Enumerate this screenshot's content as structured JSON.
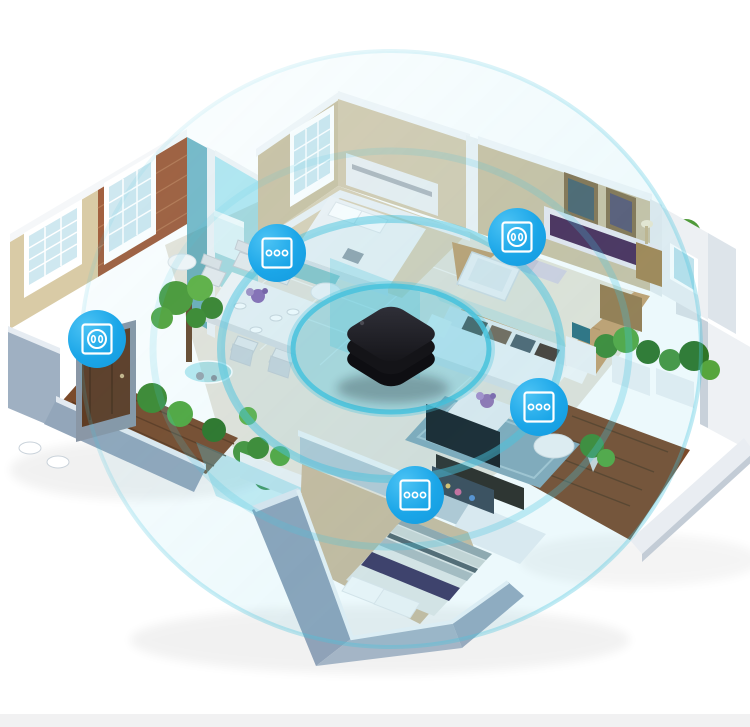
{
  "scene": {
    "type": "smart-home-product-render",
    "description": "Isometric 3D cutaway apartment; a black smart hub in the centre broadcasts teal wireless signal rings to blue smart wall-switch and power-outlet markers placed in each room",
    "background_color": "#ffffff",
    "footer_strip_color": "#f1f1f2"
  },
  "palette": {
    "device_blue": "#1ba6e8",
    "device_blue_light": "#4cc3f4",
    "wave_teal": "#49c3dd",
    "hub_black": "#1c1c20",
    "wall_tan": "#cfc4a6",
    "brick": "#a2603f",
    "wood_floor": "#c9a06c",
    "deck_wood": "#7b4a2a",
    "cut_wall_gray": "#93a6ba",
    "glass_teal": "#4ac4de"
  },
  "hub": {
    "label": "smart-hub",
    "cx": 391,
    "cy": 345
  },
  "waves": {
    "cx": 391,
    "cy": 349,
    "color": "#49c3dd",
    "rings": [
      {
        "rx": 104,
        "ry": 68,
        "fill_opacity": 0.32,
        "stroke_opacity": 0,
        "stroke_width": 0,
        "fade": false
      },
      {
        "rx": 98,
        "ry": 63,
        "fill_opacity": 0,
        "stroke_opacity": 0.85,
        "stroke_width": 5,
        "fade": false
      },
      {
        "rx": 170,
        "ry": 130,
        "fill_opacity": 0.06,
        "stroke_opacity": 0.5,
        "stroke_width": 8,
        "fade": false
      },
      {
        "rx": 238,
        "ry": 198,
        "fill_opacity": 0,
        "stroke_opacity": 0.3,
        "stroke_width": 7,
        "fade": true
      },
      {
        "rx": 310,
        "ry": 298,
        "fill_opacity": 0.1,
        "stroke_opacity": 0.35,
        "stroke_width": 4,
        "fade": true
      }
    ]
  },
  "devices": [
    {
      "id": "dining-switch",
      "type": "switch",
      "icon": "3-gang-switch-icon",
      "x": 277,
      "y": 253,
      "size": 58
    },
    {
      "id": "master-bedroom-outlet",
      "type": "outlet",
      "icon": "power-outlet-icon",
      "x": 517,
      "y": 237,
      "size": 58
    },
    {
      "id": "balcony-outlet",
      "type": "outlet",
      "icon": "power-outlet-icon",
      "x": 97,
      "y": 339,
      "size": 58
    },
    {
      "id": "living-room-switch",
      "type": "switch",
      "icon": "3-gang-switch-icon",
      "x": 539,
      "y": 407,
      "size": 58
    },
    {
      "id": "bedroom-switch",
      "type": "switch",
      "icon": "3-gang-switch-icon",
      "x": 415,
      "y": 495,
      "size": 58
    }
  ]
}
